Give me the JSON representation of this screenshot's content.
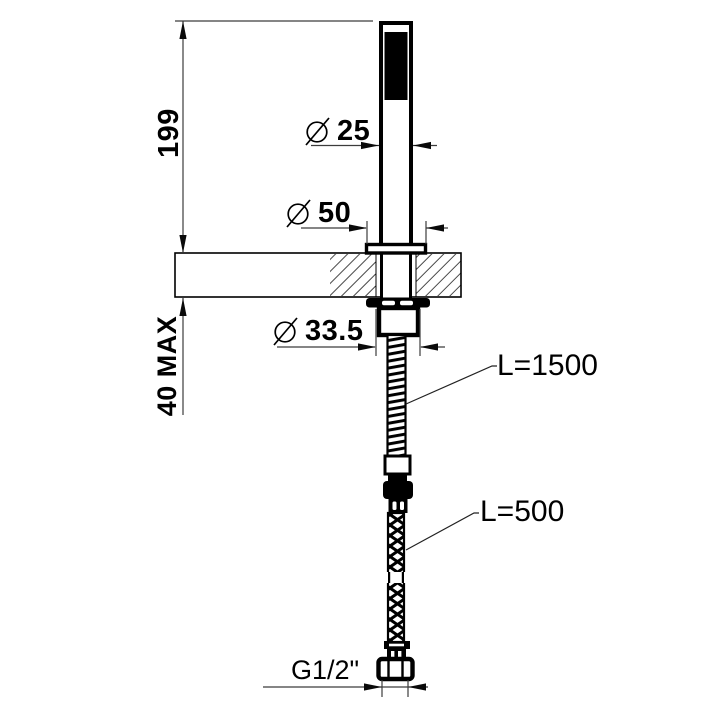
{
  "colors": {
    "background": "#ffffff",
    "ink": "#000000",
    "dim_line": "#3c3c3c"
  },
  "annotations": {
    "overall_height": "199",
    "max_counter_thickness": "40 MAX",
    "handle_diameter": {
      "symbol": "Ø",
      "value": "25"
    },
    "escutcheon_diameter": {
      "symbol": "Ø",
      "value": "50"
    },
    "underdeck_nut_diameter": {
      "symbol": "Ø",
      "value": "33.5"
    },
    "upper_hose_length": "L=1500",
    "lower_hose_length": "L=500",
    "connection_thread": "G1/2\""
  }
}
